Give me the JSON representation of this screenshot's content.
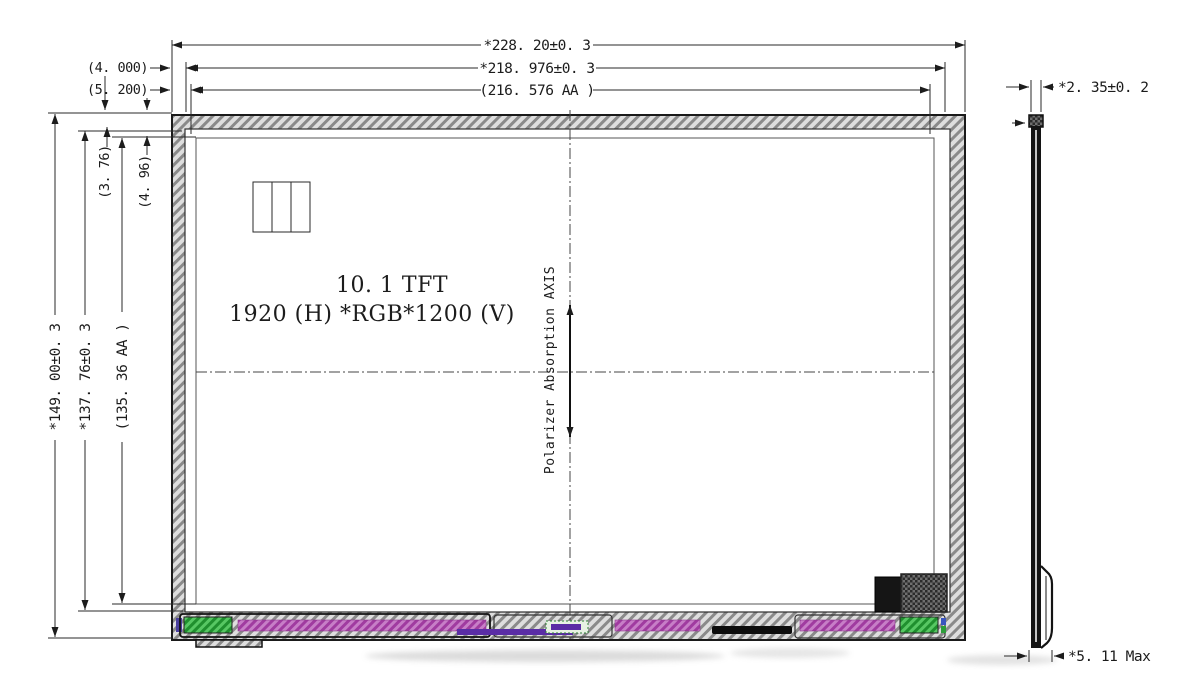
{
  "drawing": {
    "front_view": {
      "title_line1": "10. 1  TFT",
      "title_line2": "1920 (H) *RGB*1200 (V)",
      "polarizer_label": "Polarizer Absorption AXIS"
    },
    "dimensions": {
      "top_width_outline": "*228. 20±0. 3",
      "top_width_glass": "*218. 976±0. 3",
      "top_width_aa": "(216. 576 AA )",
      "top_offset_1": "(4. 000)",
      "top_offset_2": "(5. 200)",
      "left_height_outline": "*149. 00±0. 3",
      "left_height_glass": "*137. 76±0. 3",
      "left_height_aa": "(135. 36 AA )",
      "left_offset_1": "(3. 76)",
      "left_offset_2": "(4. 96)",
      "side_thickness": "*2. 35±0. 2",
      "side_max_thickness": "*5. 11 Max"
    },
    "colors": {
      "line": "#1c1c1c",
      "bezel_hatch": "#8a8a8a",
      "fpc_magenta": "#b95cb9",
      "chip_green": "#35ae43",
      "bar_purple": "#5a2da5",
      "connector_black": "#0d0d0d",
      "component_dark": "#151515"
    }
  }
}
